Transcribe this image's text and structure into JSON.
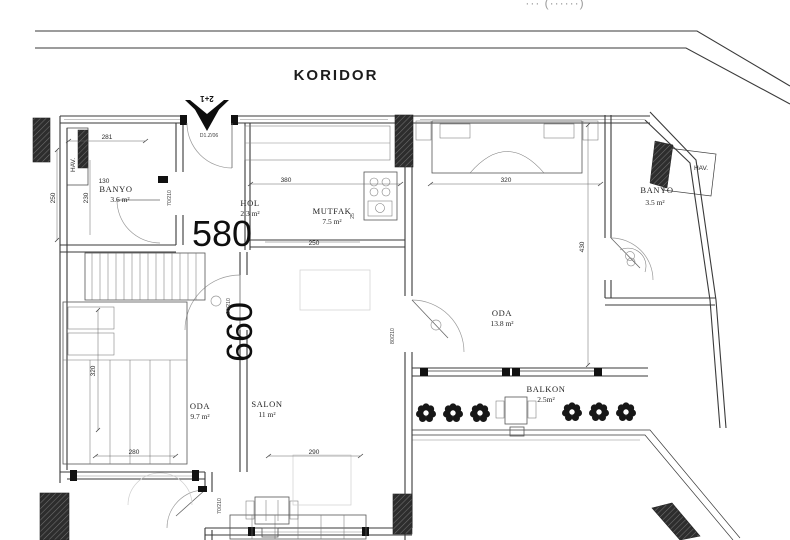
{
  "page": {
    "background": "#ffffff",
    "line_color": "#3a3a3a"
  },
  "top_cutoff_text": "··· (······)",
  "corridor": {
    "label": "KORIDOR"
  },
  "entrance": {
    "unit_type": "2+1",
    "door_code": "D1.Z/06"
  },
  "rooms": {
    "banyo1": {
      "name": "BANYO",
      "area": "3.6 m²"
    },
    "hol": {
      "name": "HOL",
      "area": "2.3 m²"
    },
    "mutfak": {
      "name": "MUTFAK",
      "area": "7.5 m²"
    },
    "oda1": {
      "name": "ODA",
      "area": "13.8 m²"
    },
    "banyo2": {
      "name": "BANYO",
      "area": "3.5 m²"
    },
    "oda2": {
      "name": "ODA",
      "area": "9.7 m²"
    },
    "salon": {
      "name": "SALON",
      "area": "11 m²"
    },
    "balkon": {
      "name": "BALKON",
      "area": "2.5m²"
    },
    "hav_left": {
      "name": "HAV."
    },
    "hav_right": {
      "name": "HAV."
    }
  },
  "overall_dims": {
    "width": "580",
    "height": "660"
  },
  "dims": {
    "top_left": "281",
    "banyo1_width": "130",
    "mutfak_top": "380",
    "oda1_top": "320",
    "left_outer": "250",
    "left_inner": "230",
    "mutfak_bottom": "250",
    "kitchen_side": "25",
    "oda1_right": "430",
    "oda2_left": "320",
    "oda2_bottom": "280",
    "salon_bottom": "290"
  },
  "doors": {
    "banyo1": "70/210",
    "oda2_salon": "90/210",
    "oda1": "80/210",
    "salon_bottom": "70/210"
  }
}
